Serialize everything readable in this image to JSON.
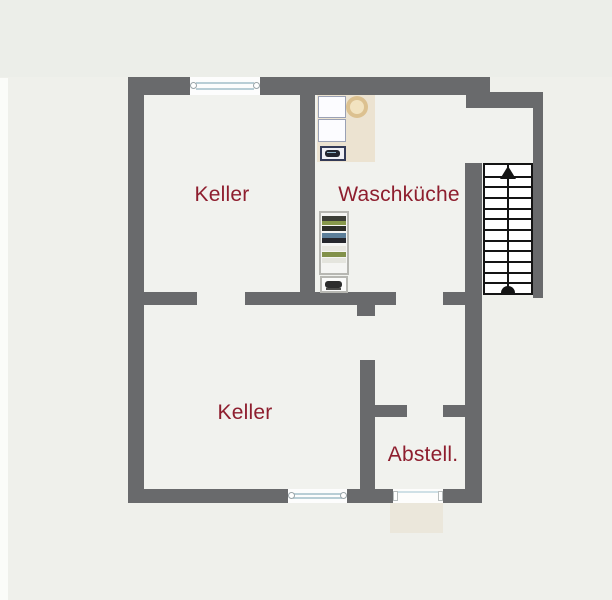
{
  "floorplan": {
    "type": "basement-floor-plan",
    "rooms": [
      {
        "id": "keller-upper",
        "label": "Keller"
      },
      {
        "id": "waschkueche",
        "label": "Waschküche"
      },
      {
        "id": "keller-lower",
        "label": "Keller"
      },
      {
        "id": "abstell",
        "label": "Abstell."
      }
    ],
    "stairs": {
      "steps": 12,
      "direction_arrow": "up"
    },
    "symbols": [
      "washing-machine",
      "dryer",
      "laundry-basket",
      "washing-machine-icon",
      "shelving-unit",
      "storage-box",
      "doormat",
      "window",
      "door-opening"
    ],
    "colors": {
      "wall": "#696a6c",
      "label_text": "#8e1e2e",
      "background": "#eff0eb",
      "interior": "#f1f2ee",
      "counter": "#ece3d1",
      "doormat": "#ebe7db",
      "window_line": "#b9ced6",
      "stair_line": "#141414"
    }
  }
}
